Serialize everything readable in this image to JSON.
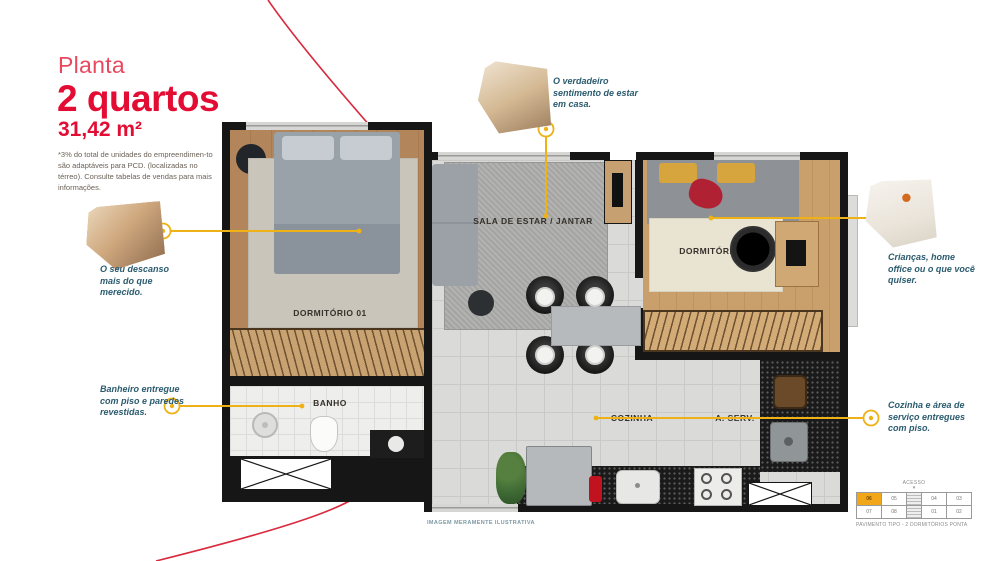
{
  "header": {
    "kicker": "Planta",
    "title": "2 quartos",
    "area": "31,42 m²",
    "disclaimer": "*3% do total de unidades do empreendimen-to são adaptáveis para PCD. (localizadas no térreo). Consulte tabelas de vendas para mais informações."
  },
  "colors": {
    "brand_red": "#e30d33",
    "accent_yellow": "#eeb216",
    "callout_text": "#2a5b6e",
    "wall_black": "#161616",
    "keyplan_highlight": "#f2a71b"
  },
  "callouts": [
    {
      "id": "descanso",
      "text": "O seu descanso mais do que merecido."
    },
    {
      "id": "sentimento",
      "text": "O verdadeiro sentimento de estar em casa."
    },
    {
      "id": "criancas",
      "text": "Crianças, home office ou o que você quiser."
    },
    {
      "id": "banheiro",
      "text": "Banheiro entregue com piso e paredes revestidas."
    },
    {
      "id": "cozinha",
      "text": "Cozinha e área de serviço entregues com piso."
    }
  ],
  "rooms": {
    "dormitorio_01": "DORMITÓRIO 01",
    "sala": "SALA DE ESTAR / JANTAR",
    "dormitorio_02": "DORMITÓRIO 02",
    "banho": "BANHO",
    "cozinha": "COZINHA",
    "area_servico": "A. SERV."
  },
  "footer": {
    "note": "IMAGEM MERAMENTE ILUSTRATIVA"
  },
  "keyplan": {
    "access": "ACESSO",
    "caption": "PAVIMENTO TIPO - 2 DORMITÓRIOS PONTA",
    "highlighted_unit": "06",
    "units_top": [
      "06",
      "05",
      "04",
      "03"
    ],
    "units_bottom": [
      "07",
      "08",
      "01",
      "02"
    ]
  }
}
